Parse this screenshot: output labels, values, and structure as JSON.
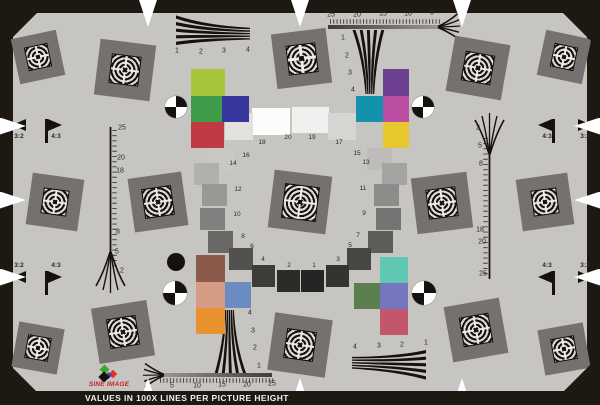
{
  "footer": {
    "text": "VALUES IN 100X LINES PER PICTURE HEIGHT"
  },
  "logo": {
    "brand": "SINE IMAGE"
  },
  "palette": {
    "background": "#c6c5c2",
    "square_gray": "#757170",
    "frame_black": "#1e1813",
    "brand_red": "#cf2027"
  },
  "ring": {
    "description": "circular 20-step grayscale",
    "patches": [
      {
        "n": "20",
        "cx": 271,
        "cy": 121,
        "w": 38,
        "h": 27,
        "hex": "#fcfcfb",
        "lx": 288,
        "ly": 138
      },
      {
        "n": "19",
        "cx": 310,
        "cy": 120,
        "w": 37,
        "h": 26,
        "hex": "#f0f0ee",
        "lx": 312,
        "ly": 138
      },
      {
        "n": "18",
        "cx": 239,
        "cy": 126,
        "w": 28,
        "h": 27,
        "hex": "#e3e1df",
        "lx": 262,
        "ly": 143
      },
      {
        "n": "17",
        "cx": 342,
        "cy": 126,
        "w": 28,
        "h": 27,
        "hex": "#d7d5d3",
        "lx": 339,
        "ly": 143
      },
      {
        "n": "16",
        "cx": 221,
        "cy": 159,
        "w": 25,
        "h": 22,
        "hex": "#cac8c6",
        "lx": 246,
        "ly": 156
      },
      {
        "n": "15",
        "cx": 379,
        "cy": 159,
        "w": 25,
        "h": 22,
        "hex": "#bebcba",
        "lx": 357,
        "ly": 154
      },
      {
        "n": "14",
        "cx": 206,
        "cy": 174,
        "w": 25,
        "h": 22,
        "hex": "#b2b0ae",
        "lx": 233,
        "ly": 164
      },
      {
        "n": "13",
        "cx": 394,
        "cy": 174,
        "w": 25,
        "h": 22,
        "hex": "#a6a4a2",
        "lx": 366,
        "ly": 163
      },
      {
        "n": "12",
        "cx": 214,
        "cy": 195,
        "w": 25,
        "h": 22,
        "hex": "#9a9896",
        "lx": 238,
        "ly": 190
      },
      {
        "n": "11",
        "cx": 386,
        "cy": 195,
        "w": 25,
        "h": 22,
        "hex": "#8e8c8a",
        "lx": 363,
        "ly": 189
      },
      {
        "n": "10",
        "cx": 212,
        "cy": 219,
        "w": 25,
        "h": 22,
        "hex": "#82807e",
        "lx": 237,
        "ly": 215
      },
      {
        "n": "9",
        "cx": 388,
        "cy": 219,
        "w": 25,
        "h": 22,
        "hex": "#767472",
        "lx": 364,
        "ly": 214
      },
      {
        "n": "8",
        "cx": 220,
        "cy": 242,
        "w": 25,
        "h": 22,
        "hex": "#6a6866",
        "lx": 243,
        "ly": 237
      },
      {
        "n": "7",
        "cx": 380,
        "cy": 242,
        "w": 25,
        "h": 22,
        "hex": "#5e5c5a",
        "lx": 358,
        "ly": 236
      },
      {
        "n": "6",
        "cx": 241,
        "cy": 259,
        "w": 24,
        "h": 22,
        "hex": "#53514f",
        "lx": 252,
        "ly": 247
      },
      {
        "n": "5",
        "cx": 359,
        "cy": 259,
        "w": 24,
        "h": 22,
        "hex": "#484644",
        "lx": 350,
        "ly": 246
      },
      {
        "n": "4",
        "cx": 263,
        "cy": 276,
        "w": 23,
        "h": 22,
        "hex": "#3e3c3a",
        "lx": 263,
        "ly": 260
      },
      {
        "n": "3",
        "cx": 337,
        "cy": 276,
        "w": 23,
        "h": 22,
        "hex": "#353331",
        "lx": 338,
        "ly": 260
      },
      {
        "n": "2",
        "cx": 288,
        "cy": 281,
        "w": 23,
        "h": 22,
        "hex": "#2d2b29",
        "lx": 289,
        "ly": 266
      },
      {
        "n": "1",
        "cx": 312,
        "cy": 281,
        "w": 23,
        "h": 22,
        "hex": "#272523",
        "lx": 314,
        "ly": 266
      }
    ]
  },
  "checkers": {
    "upper_left": [
      {
        "hex": "#a6c43c",
        "x": 191,
        "y": 69,
        "w": 34,
        "h": 27
      },
      {
        "hex": "#3f9c4b",
        "x": 191,
        "y": 96,
        "w": 31,
        "h": 26
      },
      {
        "hex": "#35379b",
        "x": 222,
        "y": 96,
        "w": 27,
        "h": 26
      },
      {
        "hex": "#bf3a43",
        "x": 191,
        "y": 122,
        "w": 33,
        "h": 26
      }
    ],
    "upper_right": [
      {
        "hex": "#6c3f90",
        "x": 383,
        "y": 69,
        "w": 26,
        "h": 27
      },
      {
        "hex": "#1392ac",
        "x": 356,
        "y": 96,
        "w": 27,
        "h": 26
      },
      {
        "hex": "#bb4fa4",
        "x": 383,
        "y": 96,
        "w": 26,
        "h": 26
      },
      {
        "hex": "#e6c72e",
        "x": 383,
        "y": 122,
        "w": 26,
        "h": 26
      }
    ],
    "lower_left": [
      {
        "hex": "#8b5a4b",
        "x": 196,
        "y": 255,
        "w": 29,
        "h": 27
      },
      {
        "hex": "#d49b85",
        "x": 196,
        "y": 282,
        "w": 29,
        "h": 26
      },
      {
        "hex": "#6b8cc2",
        "x": 225,
        "y": 282,
        "w": 26,
        "h": 26
      },
      {
        "hex": "#e8912d",
        "x": 196,
        "y": 308,
        "w": 29,
        "h": 26
      }
    ],
    "lower_right": [
      {
        "hex": "#5fc7b2",
        "x": 380,
        "y": 257,
        "w": 28,
        "h": 26
      },
      {
        "hex": "#5b7f4e",
        "x": 354,
        "y": 283,
        "w": 26,
        "h": 26
      },
      {
        "hex": "#7477bf",
        "x": 380,
        "y": 283,
        "w": 28,
        "h": 26
      },
      {
        "hex": "#c4566b",
        "x": 380,
        "y": 309,
        "w": 28,
        "h": 26
      }
    ]
  },
  "squares": [
    {
      "x": 38,
      "y": 57,
      "s": 46,
      "rot": -12,
      "m": 22
    },
    {
      "x": 564,
      "y": 57,
      "s": 46,
      "rot": 12,
      "m": 22
    },
    {
      "x": 38,
      "y": 348,
      "s": 46,
      "rot": 10,
      "m": 22
    },
    {
      "x": 564,
      "y": 349,
      "s": 46,
      "rot": -10,
      "m": 22
    },
    {
      "x": 55,
      "y": 202,
      "s": 52,
      "rot": 8,
      "m": 24
    },
    {
      "x": 545,
      "y": 202,
      "s": 52,
      "rot": -8,
      "m": 24
    },
    {
      "x": 125,
      "y": 70,
      "s": 56,
      "rot": 7,
      "m": 28
    },
    {
      "x": 301,
      "y": 58,
      "s": 55,
      "rot": -7,
      "m": 28
    },
    {
      "x": 478,
      "y": 68,
      "s": 56,
      "rot": 10,
      "m": 28
    },
    {
      "x": 158,
      "y": 202,
      "s": 54,
      "rot": -8,
      "m": 28
    },
    {
      "x": 300,
      "y": 202,
      "s": 58,
      "rot": 7,
      "m": 33
    },
    {
      "x": 442,
      "y": 203,
      "s": 56,
      "rot": -7,
      "m": 28
    },
    {
      "x": 123,
      "y": 332,
      "s": 56,
      "rot": -9,
      "m": 28
    },
    {
      "x": 300,
      "y": 345,
      "s": 58,
      "rot": 8,
      "m": 28
    },
    {
      "x": 476,
      "y": 330,
      "s": 56,
      "rot": -10,
      "m": 28
    }
  ],
  "bullseyes": [
    {
      "x": 176,
      "y": 107,
      "r": 11
    },
    {
      "x": 423,
      "y": 107,
      "r": 11
    },
    {
      "x": 175,
      "y": 293,
      "r": 12
    },
    {
      "x": 424,
      "y": 293,
      "r": 12
    }
  ],
  "focus_dot": {
    "x": 176,
    "y": 262,
    "r": 9
  },
  "flags": [
    {
      "label": "3:2",
      "tx": 19,
      "ty": 137,
      "px": 12,
      "py": 119,
      "dir": "left"
    },
    {
      "label": "4:3",
      "tx": 56,
      "ty": 137,
      "px": 48,
      "py": 119,
      "dir": "right",
      "pole_x": 45,
      "pole_y": 119,
      "pole_h": 24
    },
    {
      "label": "3:2",
      "tx": 19,
      "ty": 266,
      "px": 12,
      "py": 271,
      "dir": "left"
    },
    {
      "label": "4:3",
      "tx": 56,
      "ty": 266,
      "px": 48,
      "py": 271,
      "dir": "right",
      "pole_x": 45,
      "pole_y": 271,
      "pole_h": 24
    },
    {
      "label": "4:3",
      "tx": 547,
      "ty": 137,
      "px": 538,
      "py": 119,
      "dir": "left",
      "pole_x": 552,
      "pole_y": 119,
      "pole_h": 24
    },
    {
      "label": "3:2",
      "tx": 585,
      "ty": 137,
      "px": 578,
      "py": 119,
      "dir": "right"
    },
    {
      "label": "4:3",
      "tx": 547,
      "ty": 266,
      "px": 538,
      "py": 271,
      "dir": "left",
      "pole_x": 552,
      "pole_y": 271,
      "pole_h": 24
    },
    {
      "label": "3:2",
      "tx": 585,
      "ty": 266,
      "px": 578,
      "py": 271,
      "dir": "right"
    }
  ],
  "labels": {
    "wedge_top_left": [
      {
        "t": "1",
        "x": 177,
        "y": 51
      },
      {
        "t": "2",
        "x": 201,
        "y": 52
      },
      {
        "t": "3",
        "x": 224,
        "y": 51
      },
      {
        "t": "4",
        "x": 248,
        "y": 50
      }
    ],
    "wedge_top_center": [
      {
        "t": "1",
        "x": 343,
        "y": 38
      },
      {
        "t": "2",
        "x": 347,
        "y": 56
      },
      {
        "t": "3",
        "x": 350,
        "y": 73
      },
      {
        "t": "4",
        "x": 353,
        "y": 90
      }
    ],
    "wedge_bottom_center": [
      {
        "t": "4",
        "x": 250,
        "y": 313
      },
      {
        "t": "3",
        "x": 253,
        "y": 331
      },
      {
        "t": "2",
        "x": 255,
        "y": 348
      },
      {
        "t": "1",
        "x": 259,
        "y": 366
      }
    ],
    "wedge_bottom_right": [
      {
        "t": "4",
        "x": 355,
        "y": 347
      },
      {
        "t": "3",
        "x": 379,
        "y": 346
      },
      {
        "t": "2",
        "x": 402,
        "y": 345
      },
      {
        "t": "1",
        "x": 426,
        "y": 343
      }
    ],
    "ruler_top": [
      {
        "t": "25",
        "x": 331,
        "y": 15
      },
      {
        "t": "20",
        "x": 357,
        "y": 15
      },
      {
        "t": "15",
        "x": 383,
        "y": 14
      },
      {
        "t": "10",
        "x": 408,
        "y": 14
      },
      {
        "t": "5",
        "x": 432,
        "y": 13
      }
    ],
    "ruler_bottom": [
      {
        "t": "5",
        "x": 172,
        "y": 386
      },
      {
        "t": "10",
        "x": 197,
        "y": 386
      },
      {
        "t": "15",
        "x": 222,
        "y": 385
      },
      {
        "t": "20",
        "x": 247,
        "y": 385
      },
      {
        "t": "25",
        "x": 272,
        "y": 384
      }
    ],
    "ruler_left": [
      {
        "t": "25",
        "x": 122,
        "y": 128
      },
      {
        "t": "20",
        "x": 121,
        "y": 158
      },
      {
        "t": "18",
        "x": 120,
        "y": 171
      },
      {
        "t": "8",
        "x": 118,
        "y": 232
      },
      {
        "t": "5",
        "x": 117,
        "y": 252
      },
      {
        "t": "2",
        "x": 122,
        "y": 271
      }
    ],
    "ruler_right": [
      {
        "t": "2",
        "x": 478,
        "y": 128
      },
      {
        "t": "5",
        "x": 480,
        "y": 146
      },
      {
        "t": "8",
        "x": 481,
        "y": 164
      },
      {
        "t": "18",
        "x": 480,
        "y": 230
      },
      {
        "t": "20",
        "x": 482,
        "y": 242
      },
      {
        "t": "25",
        "x": 483,
        "y": 274
      }
    ]
  },
  "border_triangles": {
    "top_x": [
      148,
      300,
      462
    ],
    "bottom_x": [
      148,
      300,
      462
    ],
    "left_y": [
      126,
      200,
      277
    ],
    "right_y": [
      126,
      200,
      277
    ]
  }
}
